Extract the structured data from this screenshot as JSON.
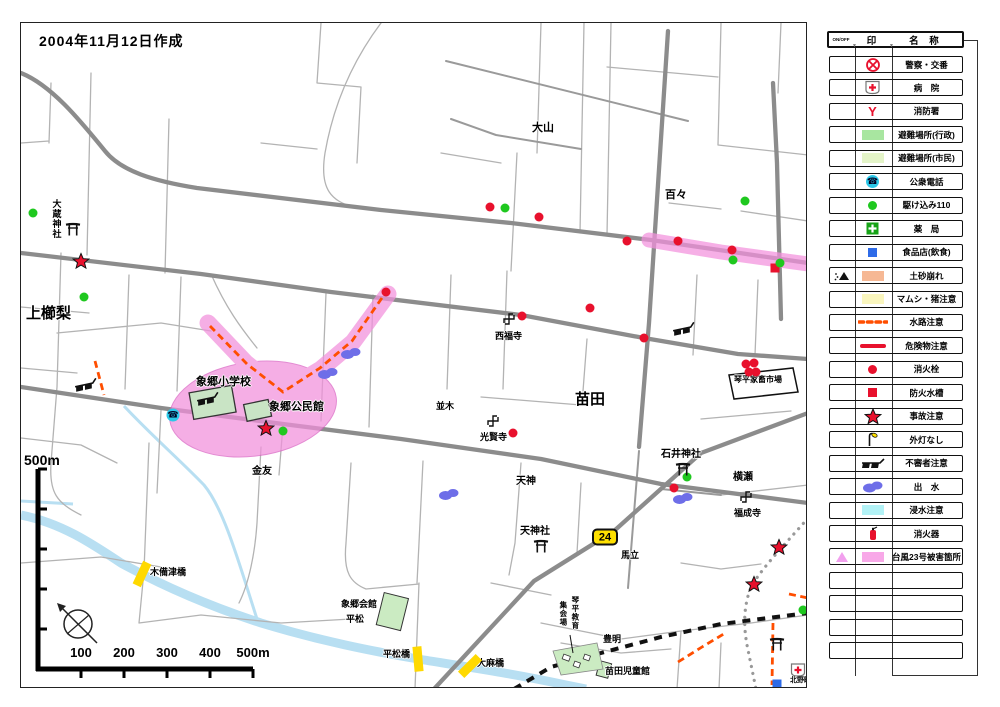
{
  "title": "2004年11月12日作成",
  "route_badge": "24",
  "scale": {
    "top_label": "500m",
    "tick_labels": [
      "100",
      "200",
      "300",
      "400",
      "500m"
    ]
  },
  "colors": {
    "typhoon_pink": "#F290DC",
    "road_gray": "#8c8c8c",
    "river_blue": "#B8DFF2",
    "caution_orange": "#FF4E00",
    "marker_red": "#E8112D",
    "marker_green": "#1FC81F"
  },
  "map_labels": [
    {
      "name": "kamikushinashi",
      "text": "上櫛梨",
      "x": 5,
      "y": 283,
      "size": 15
    },
    {
      "name": "okura-jinja",
      "text": "大蔵神社",
      "x": 30,
      "y": 176,
      "size": 9,
      "vertical": true
    },
    {
      "name": "oyama",
      "text": "大山",
      "x": 511,
      "y": 100,
      "size": 11
    },
    {
      "name": "dodo",
      "text": "百々",
      "x": 644,
      "y": 167,
      "size": 11
    },
    {
      "name": "naeda",
      "text": "苗田",
      "x": 554,
      "y": 369,
      "size": 15
    },
    {
      "name": "saifukuji",
      "text": "西福寺",
      "x": 474,
      "y": 309,
      "size": 9
    },
    {
      "name": "kokenji",
      "text": "光賢寺",
      "x": 459,
      "y": 410,
      "size": 9
    },
    {
      "name": "namiki",
      "text": "並木",
      "x": 415,
      "y": 379,
      "size": 9
    },
    {
      "name": "tenjin",
      "text": "天神",
      "x": 495,
      "y": 454,
      "size": 10
    },
    {
      "name": "tenjinsha",
      "text": "天神社",
      "x": 499,
      "y": 504,
      "size": 10
    },
    {
      "name": "ishii-jinja",
      "text": "石井神社",
      "x": 640,
      "y": 427,
      "size": 10
    },
    {
      "name": "yokoze",
      "text": "横瀬",
      "x": 712,
      "y": 450,
      "size": 10
    },
    {
      "name": "fukuseiji",
      "text": "福成寺",
      "x": 713,
      "y": 486,
      "size": 9
    },
    {
      "name": "umatate",
      "text": "馬立",
      "x": 600,
      "y": 528,
      "size": 9
    },
    {
      "name": "kanetomo",
      "text": "金友",
      "x": 231,
      "y": 444,
      "size": 10
    },
    {
      "name": "kotohira-kachiku-ichiba",
      "text": "琴平家畜市場",
      "x": 713,
      "y": 353,
      "size": 8
    },
    {
      "name": "zogo-shogakko",
      "text": "象郷小学校",
      "x": 175,
      "y": 354,
      "size": 11
    },
    {
      "name": "zogo-kominkan",
      "text": "象郷公民館",
      "x": 248,
      "y": 379,
      "size": 11
    },
    {
      "name": "kibitsubashi",
      "text": "木備津橋",
      "x": 129,
      "y": 545,
      "size": 9
    },
    {
      "name": "hiramatsubashi",
      "text": "平松橋",
      "x": 362,
      "y": 627,
      "size": 9
    },
    {
      "name": "taimabashi",
      "text": "大麻橋",
      "x": 456,
      "y": 636,
      "size": 9
    },
    {
      "name": "zogo-kaikan",
      "text": "象郷会館",
      "x": 320,
      "y": 577,
      "size": 9
    },
    {
      "name": "hiramatsu",
      "text": "平松",
      "x": 325,
      "y": 592,
      "size": 9
    },
    {
      "name": "toyoakira",
      "text": "豊明",
      "x": 582,
      "y": 612,
      "size": 9
    },
    {
      "name": "naeda-jidokan",
      "text": "苗田児童館",
      "x": 584,
      "y": 644,
      "size": 9
    },
    {
      "name": "kitanocho",
      "text": "北野町",
      "x": 769,
      "y": 654,
      "size": 7
    },
    {
      "name": "kotohira-kyoiku",
      "text": "琴平教育",
      "x": 550,
      "y": 573,
      "size": 7.5,
      "vertical": true
    },
    {
      "name": "shukaijo",
      "text": "集会場",
      "x": 538,
      "y": 578,
      "size": 7.5,
      "vertical": true
    }
  ],
  "map_icons": [
    {
      "type": "star",
      "x": 60,
      "y": 238
    },
    {
      "type": "star",
      "x": 245,
      "y": 405
    },
    {
      "type": "star",
      "x": 758,
      "y": 524
    },
    {
      "type": "star",
      "x": 733,
      "y": 561
    },
    {
      "type": "hydrant",
      "x": 365,
      "y": 269
    },
    {
      "type": "hydrant",
      "x": 469,
      "y": 184
    },
    {
      "type": "hydrant",
      "x": 518,
      "y": 194
    },
    {
      "type": "hydrant",
      "x": 501,
      "y": 293
    },
    {
      "type": "hydrant",
      "x": 569,
      "y": 285
    },
    {
      "type": "hydrant",
      "x": 623,
      "y": 315
    },
    {
      "type": "hydrant",
      "x": 606,
      "y": 218
    },
    {
      "type": "hydrant",
      "x": 657,
      "y": 218
    },
    {
      "type": "hydrant",
      "x": 711,
      "y": 227
    },
    {
      "type": "hydrant",
      "x": 725,
      "y": 341
    },
    {
      "type": "hydrant",
      "x": 733,
      "y": 340
    },
    {
      "type": "hydrant",
      "x": 728,
      "y": 349
    },
    {
      "type": "hydrant",
      "x": 735,
      "y": 349
    },
    {
      "type": "hydrant",
      "x": 492,
      "y": 410
    },
    {
      "type": "hydrant",
      "x": 653,
      "y": 465
    },
    {
      "type": "tank",
      "x": 754,
      "y": 245
    },
    {
      "type": "dot110",
      "x": 12,
      "y": 190
    },
    {
      "type": "dot110",
      "x": 63,
      "y": 274
    },
    {
      "type": "dot110",
      "x": 484,
      "y": 185
    },
    {
      "type": "dot110",
      "x": 724,
      "y": 178
    },
    {
      "type": "dot110",
      "x": 712,
      "y": 237
    },
    {
      "type": "dot110",
      "x": 759,
      "y": 240
    },
    {
      "type": "dot110",
      "x": 262,
      "y": 408
    },
    {
      "type": "dot110",
      "x": 666,
      "y": 454
    },
    {
      "type": "dot110",
      "x": 782,
      "y": 587
    },
    {
      "type": "blob",
      "x": 330,
      "y": 330
    },
    {
      "type": "blob",
      "x": 307,
      "y": 350
    },
    {
      "type": "blob",
      "x": 428,
      "y": 471
    },
    {
      "type": "blob",
      "x": 662,
      "y": 475
    },
    {
      "type": "phone",
      "x": 152,
      "y": 392
    },
    {
      "type": "sunglasses",
      "x": 65,
      "y": 362
    },
    {
      "type": "sunglasses",
      "x": 187,
      "y": 376
    },
    {
      "type": "sunglasses",
      "x": 663,
      "y": 306
    },
    {
      "type": "torii",
      "x": 52,
      "y": 206
    },
    {
      "type": "torii",
      "x": 662,
      "y": 446
    },
    {
      "type": "torii",
      "x": 520,
      "y": 523
    },
    {
      "type": "torii",
      "x": 756,
      "y": 621
    },
    {
      "type": "manji",
      "x": 488,
      "y": 296
    },
    {
      "type": "manji",
      "x": 472,
      "y": 398
    },
    {
      "type": "manji",
      "x": 725,
      "y": 474
    },
    {
      "type": "hospital",
      "x": 777,
      "y": 647
    },
    {
      "type": "foodstore",
      "x": 756,
      "y": 661
    },
    {
      "type": "bridge",
      "x": 121,
      "y": 551,
      "rot": 25
    },
    {
      "type": "bridge",
      "x": 397,
      "y": 636,
      "rot": -5
    },
    {
      "type": "bridge",
      "x": 449,
      "y": 643,
      "rot": 45
    }
  ],
  "legend": {
    "header": {
      "onoff": "ON/OFF",
      "mark": "印",
      "name": "名 称"
    },
    "rows": [
      {
        "icon": "police",
        "label": "警察・交番"
      },
      {
        "icon": "hospital",
        "label": "病　院"
      },
      {
        "icon": "firestation",
        "label": "消防署"
      },
      {
        "icon": "evac1",
        "label": "避難場所(行政)"
      },
      {
        "icon": "evac2",
        "label": "避難場所(市民)"
      },
      {
        "icon": "phone",
        "label": "公衆電話"
      },
      {
        "icon": "dot110",
        "label": "駆け込み110"
      },
      {
        "icon": "pharmacy",
        "label": "薬　局"
      },
      {
        "icon": "foodstore",
        "label": "食品店(飲食)"
      },
      {
        "icon": "landslide",
        "pre": "mountain",
        "label": "土砂崩れ"
      },
      {
        "icon": "viper",
        "label": "マムシ・猪注意"
      },
      {
        "icon": "waterway",
        "label": "水路注意"
      },
      {
        "icon": "hazmat",
        "label": "危険物注意"
      },
      {
        "icon": "hydrant",
        "label": "消火栓"
      },
      {
        "icon": "tank",
        "label": "防火水槽"
      },
      {
        "icon": "star",
        "label": "事故注意"
      },
      {
        "icon": "lamp",
        "label": "外灯なし"
      },
      {
        "icon": "sunglasses",
        "label": "不審者注意"
      },
      {
        "icon": "blob",
        "label": "出　水"
      },
      {
        "icon": "floodrect",
        "label": "浸水注意"
      },
      {
        "icon": "extinguisher",
        "label": "消火器"
      },
      {
        "icon": "typhoonrect",
        "pre": "pinktri",
        "label": "台風23号被害箇所"
      },
      {
        "icon": "",
        "label": ""
      },
      {
        "icon": "",
        "label": ""
      },
      {
        "icon": "",
        "label": ""
      },
      {
        "icon": "",
        "label": ""
      }
    ]
  }
}
